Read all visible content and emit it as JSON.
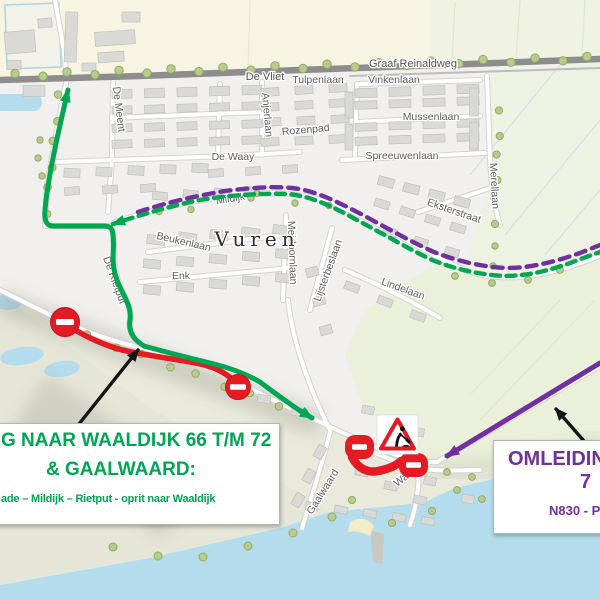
{
  "map": {
    "town": "Vuren",
    "streets": {
      "de_vliet": "De Vliet",
      "tulpenlaan": "Tulpenlaan",
      "vinkenlaan": "Vinkenlaan",
      "graaf_reinaldweg": "Graaf Reinaldweg",
      "de_meent": "De Meent",
      "anjerlaan": "Anjerlaan",
      "rozenpad": "Rozenpad",
      "mussenlaan": "Mussenlaan",
      "de_waay": "De Waay",
      "spreeuwenlaan": "Spreeuwenlaan",
      "merellaan": "Merellaan",
      "eksterstraat": "Eksterstraat",
      "mildijk": "Mildijk",
      "beukenlaan": "Beukenlaan",
      "meidoornlaan": "Meidoornlaan",
      "enk": "Enk",
      "lindelaan": "Lindelaan",
      "lijsterbeslaan": "Lijsterbeslaan",
      "de_rietput": "De Rietput",
      "gaalwaard": "Gaalwaard",
      "waaldijk": "Waaldijk"
    }
  },
  "legend": {
    "green_box": {
      "line1": "G NAAR WAALDIJK 66 T/M 72",
      "line2": "& GAALWAARD:",
      "line3": "ade – Mildijk – Rietput - oprit naar Waaldijk",
      "text_color": "#00a651"
    },
    "purple_box": {
      "line1": "OMLEIDIN",
      "line2": "7",
      "line3": "N830 - P",
      "text_color": "#7030a0"
    }
  },
  "routes": {
    "local_access_green": "#00a651",
    "detour_dashed_green": "#00a651",
    "detour_dashed_purple": "#7030a0",
    "detour_solid_purple": "#7030a0",
    "closed_road_red": "#e41b23"
  },
  "icons": {
    "no_entry": "no-entry-sign",
    "roadworks": "roadworks-triangle-sign"
  }
}
